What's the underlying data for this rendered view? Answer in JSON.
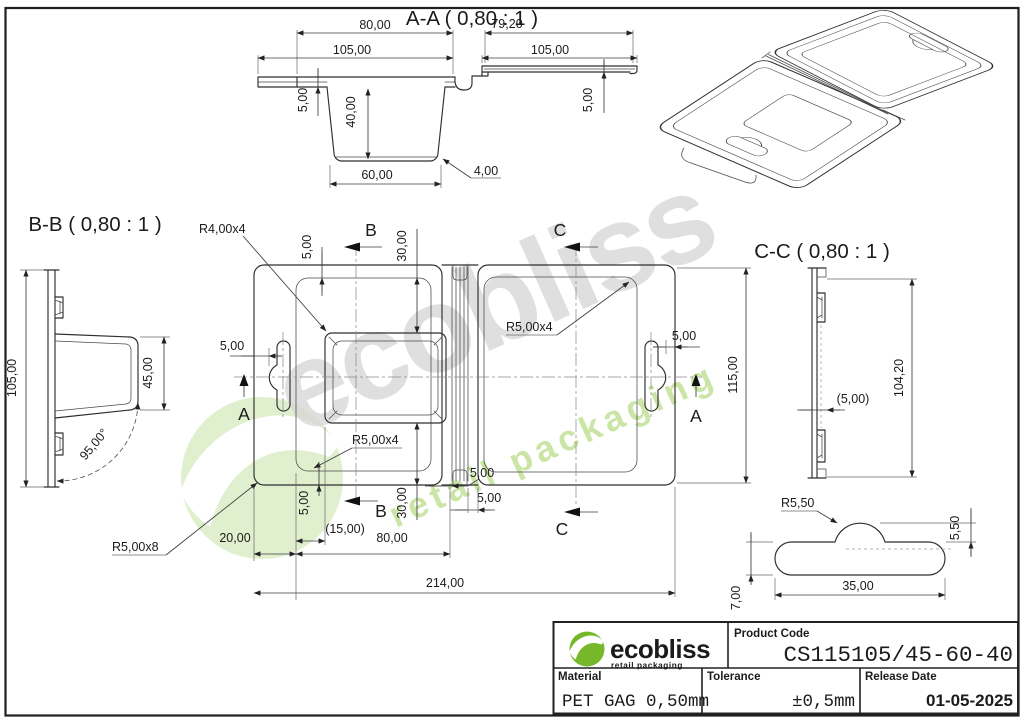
{
  "drawing": {
    "watermark": {
      "name": "ecobliss",
      "tagline": "retail packaging"
    },
    "brand": {
      "name": "ecobliss",
      "tagline": "retail packaging"
    },
    "colors": {
      "brand_green": "#76b82a",
      "tagline_green": "#8dc63f",
      "line": "#2e2e2e",
      "watermark_gray": "#d8d8d8",
      "watermark_green": "#c9e4a2"
    },
    "views": {
      "aa": {
        "title": "A-A ( 0,80 : 1 )",
        "dims": {
          "w80": "80,00",
          "w105_left": "105,00",
          "h5_left": "5,00",
          "h40": "40,00",
          "w60": "60,00",
          "r4": "4,00",
          "w7920": "79,20",
          "w105_right": "105,00",
          "h5_right": "5,00"
        }
      },
      "bb": {
        "title": "B-B ( 0,80 : 1 )",
        "dims": {
          "h105": "105,00",
          "h45": "45,00",
          "a95": "95,00°"
        }
      },
      "cc": {
        "title": "C-C ( 0,80 : 1 )",
        "dims": {
          "h10420": "104,20",
          "g500": "(5,00)",
          "r550": "R5,50"
        }
      },
      "plan": {
        "section_a": "A",
        "section_b": "B",
        "section_c": "C",
        "labels": {
          "r4x4": "R4,00x4",
          "r5x4_left": "R5,00x4",
          "r5x4_right": "R5,00x4",
          "r5x8": "R5,00x8"
        },
        "dims": {
          "top5": "5,00",
          "top30": "30,00",
          "left5": "5,00",
          "right5": "5,00",
          "height115": "115,00",
          "hinge5_top": "5,00",
          "hinge5_bottom": "5,00",
          "bottom5": "5,00",
          "bottom30": "30,00",
          "offset15": "(15,00)",
          "left20": "20,00",
          "width80": "80,00",
          "total214": "214,00"
        }
      },
      "slot_detail": {
        "dims": {
          "h550": "5,50",
          "w35": "35,00",
          "h7": "7,00"
        }
      }
    },
    "title_block": {
      "product_code_label": "Product Code",
      "product_code": "CS115105/45-60-40",
      "material_label": "Material",
      "material": "PET GAG 0,50mm",
      "tolerance_label": "Tolerance",
      "tolerance": "±0,5mm",
      "release_label": "Release Date",
      "release_date": "01-05-2025"
    }
  }
}
